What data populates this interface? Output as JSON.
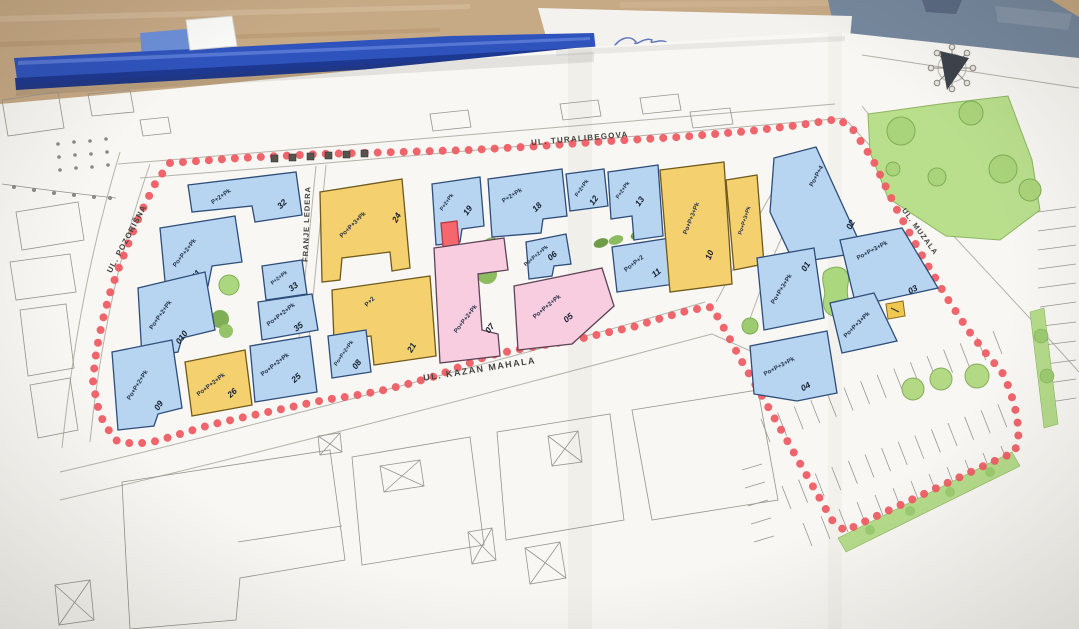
{
  "scene": {
    "description": "Photo of an urban-block site plan laid on a wooden desk",
    "desk_color": "#c6a985",
    "binder_color": "#2f53bd",
    "folder_color": "#76889e",
    "paper_color": "#f8f7f3",
    "signature_note": "illegible blue-ink signature"
  },
  "plan": {
    "boundary_color": "#ef5d64",
    "streets": {
      "top": "UL. TURALIBEGOVA",
      "left": "UL. POZORIŠNA",
      "middle": "FRANJE LEDERA",
      "bottom": "UL. KAZAN MAHALA",
      "right": "UL. MUZALA"
    },
    "building_colors": {
      "blue": "#b7d5f1",
      "yellow": "#f5d06f",
      "pink": "#f8cde0",
      "green": "#abd77f",
      "highlight_red": "#f3676d"
    },
    "buildings": [
      {
        "floors": "P+2+Pk",
        "number": "32"
      },
      {
        "floors": "Po+P+2+Pk",
        "number": "011"
      },
      {
        "floors": "Po+P+2+Pk",
        "number": "010"
      },
      {
        "floors": "Po+P+2+Pk",
        "number": "09"
      },
      {
        "floors": "Po+P+2+Pk",
        "number": "26"
      },
      {
        "floors": "Po+P+2+Pk",
        "number": "25"
      },
      {
        "floors": "P+2+Pk",
        "number": "33"
      },
      {
        "floors": "Po+P+2+Pk",
        "number": "35"
      },
      {
        "floors": "Po+P+3+Pk",
        "number": "24"
      },
      {
        "floors": "P+2",
        "number": "21"
      },
      {
        "floors": "Po+P+2+Pk",
        "number": "08"
      },
      {
        "floors": "P+2+Pk",
        "number": "19"
      },
      {
        "floors": "P+2+Pk",
        "number": "18"
      },
      {
        "floors": "Po+P+2+Pk",
        "number": "07"
      },
      {
        "floors": "Po+P+2+Pk",
        "number": "05"
      },
      {
        "floors": "Po+P+2+Pk",
        "number": "06"
      },
      {
        "floors": "P+2+Pk",
        "number": "12"
      },
      {
        "floors": "P+2+Pk",
        "number": "13"
      },
      {
        "floors": "Po+P+2",
        "number": "11"
      },
      {
        "floors": "Po+P+3+Pk",
        "number": "10"
      },
      {
        "floors": "Po+P+3+Pk",
        "number": ""
      },
      {
        "floors": "Po+P+4",
        "number": "02"
      },
      {
        "floors": "Po+P+3+Pk",
        "number": "01"
      },
      {
        "floors": "Po+P+3+Pk",
        "number": "03"
      },
      {
        "floors": "Po+P+3+Pk",
        "number": "04"
      },
      {
        "floors": "Po+P+3+Pk",
        "number": ""
      }
    ]
  }
}
